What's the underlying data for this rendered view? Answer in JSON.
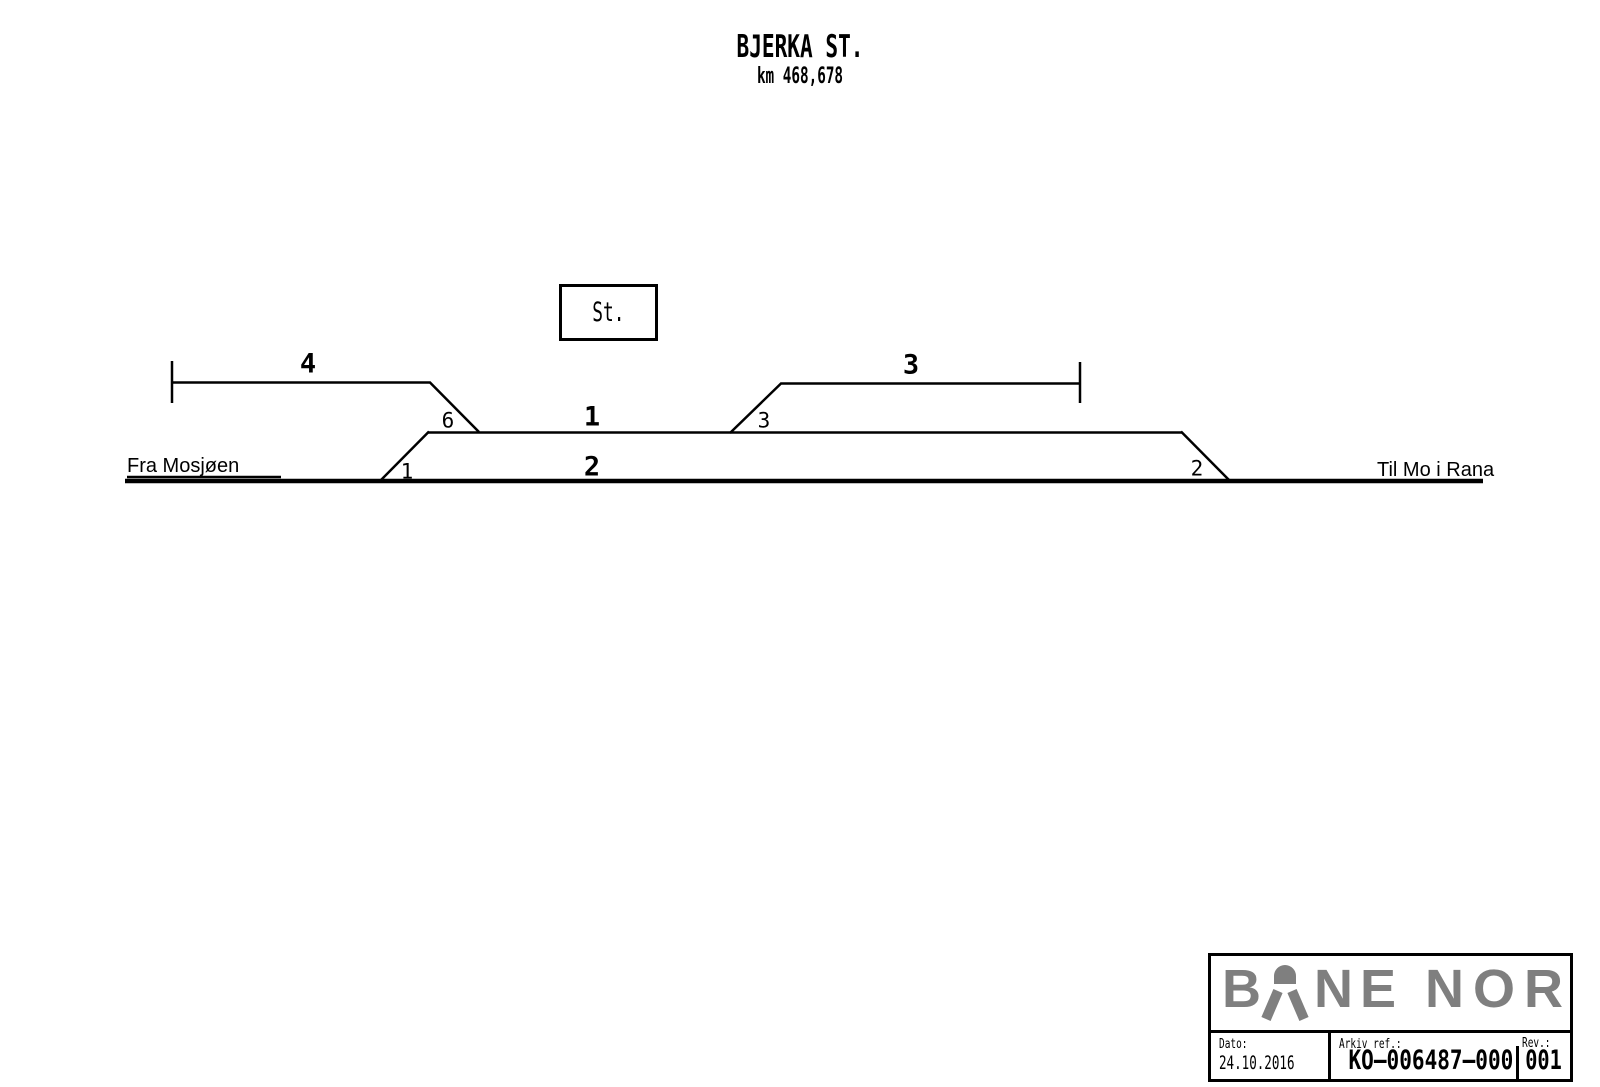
{
  "header": {
    "title": "BJERKA ST.",
    "subtitle": "km 468,678"
  },
  "station_box": {
    "label": "St."
  },
  "diagram": {
    "from_label": "Fra Mosjøen",
    "to_label": "Til Mo i Rana",
    "tracks": {
      "t1": "1",
      "t2": "2",
      "t3": "3",
      "t4": "4"
    },
    "switches": {
      "s1": "1",
      "s2": "2",
      "s3": "3",
      "s6": "6"
    }
  },
  "title_block": {
    "logo": {
      "left": "B",
      "mid": "NE",
      "right": "NOR",
      "color": "#7f7f7f"
    },
    "date_label": "Dato:",
    "date_value": "24.10.2016",
    "archive_label": "Arkiv ref.:",
    "archive_value": "KO–006487–000",
    "rev_label": "Rev.:",
    "rev_value": "001"
  },
  "colors": {
    "line": "#000000",
    "logo_gray": "#7f7f7f"
  }
}
